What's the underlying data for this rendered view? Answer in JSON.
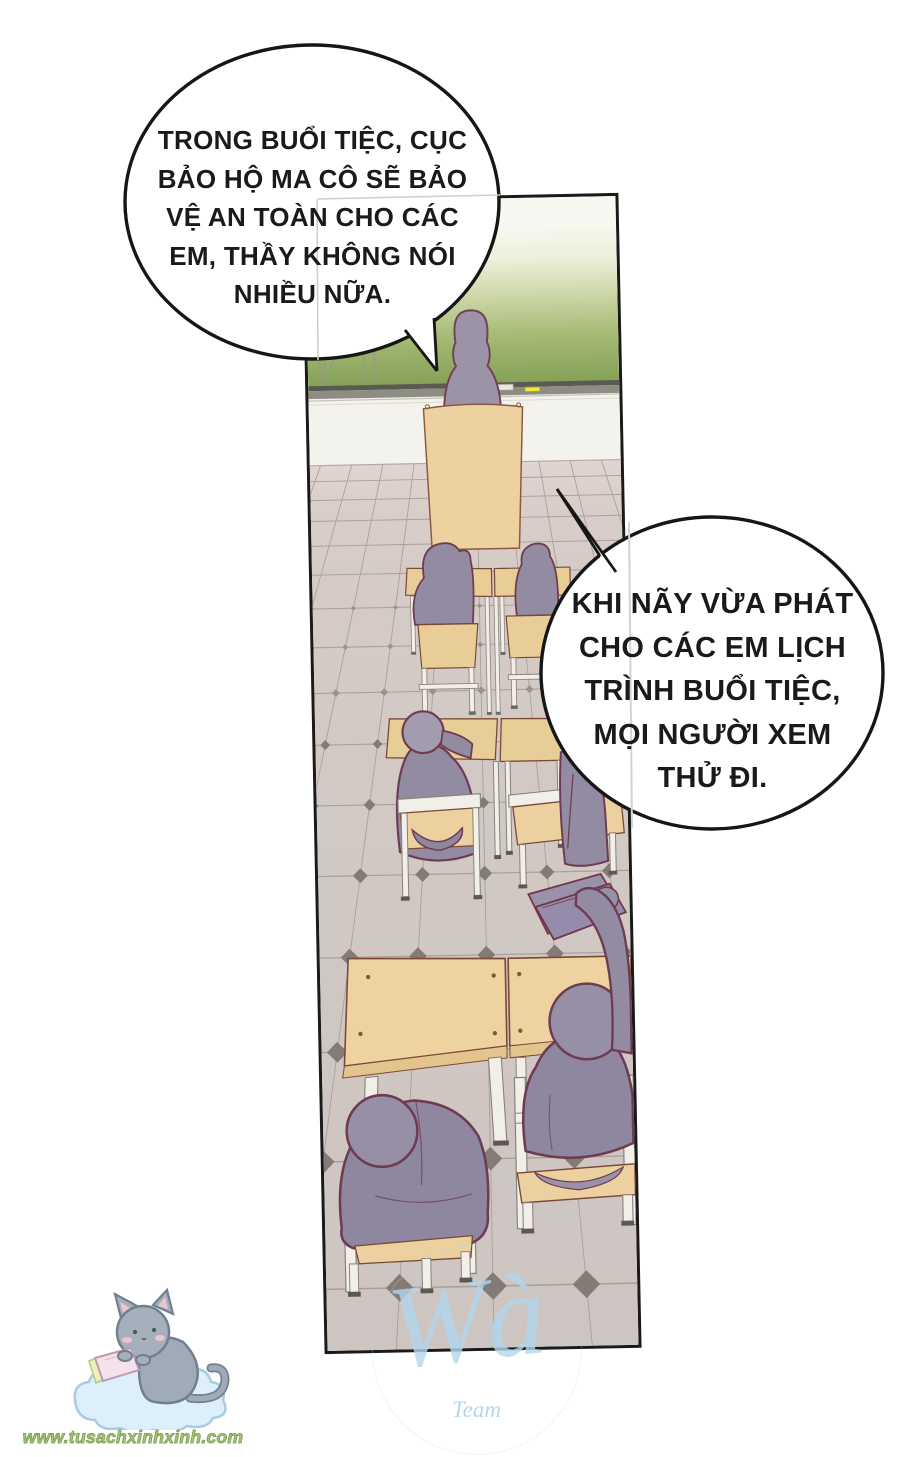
{
  "bubbles": [
    {
      "lines": [
        "TRONG BUỔI TIỆC, CỤC",
        "BẢO HỘ MA CÔ SẼ BẢO",
        "VỆ AN TOÀN CHO CÁC",
        "EM, THẦY KHÔNG NÓI",
        "NHIỀU NỮA."
      ]
    },
    {
      "lines": [
        "KHI NÃY VỪA PHÁT",
        "CHO CÁC EM LỊCH",
        "TRÌNH BUỔI TIỆC,",
        "MỌI NGƯỜI XEM",
        "THỬ ĐI."
      ]
    }
  ],
  "watermarks": {
    "site_url": "www.tusachxinhxinh.com",
    "team_logo": "Wà",
    "team_label": "Team"
  },
  "palette": {
    "panel_border": "#1a1a1a",
    "board_green": "#8fa861",
    "floor_tile": "#d2c8c3",
    "desk_wood": "#ecd2a0",
    "figure_fill": "#938ba1",
    "figure_outline": "#6e3c52",
    "bubble_outline": "#161616",
    "watermark_blue": "#b3d6ee",
    "url_green": "#9cb873"
  }
}
